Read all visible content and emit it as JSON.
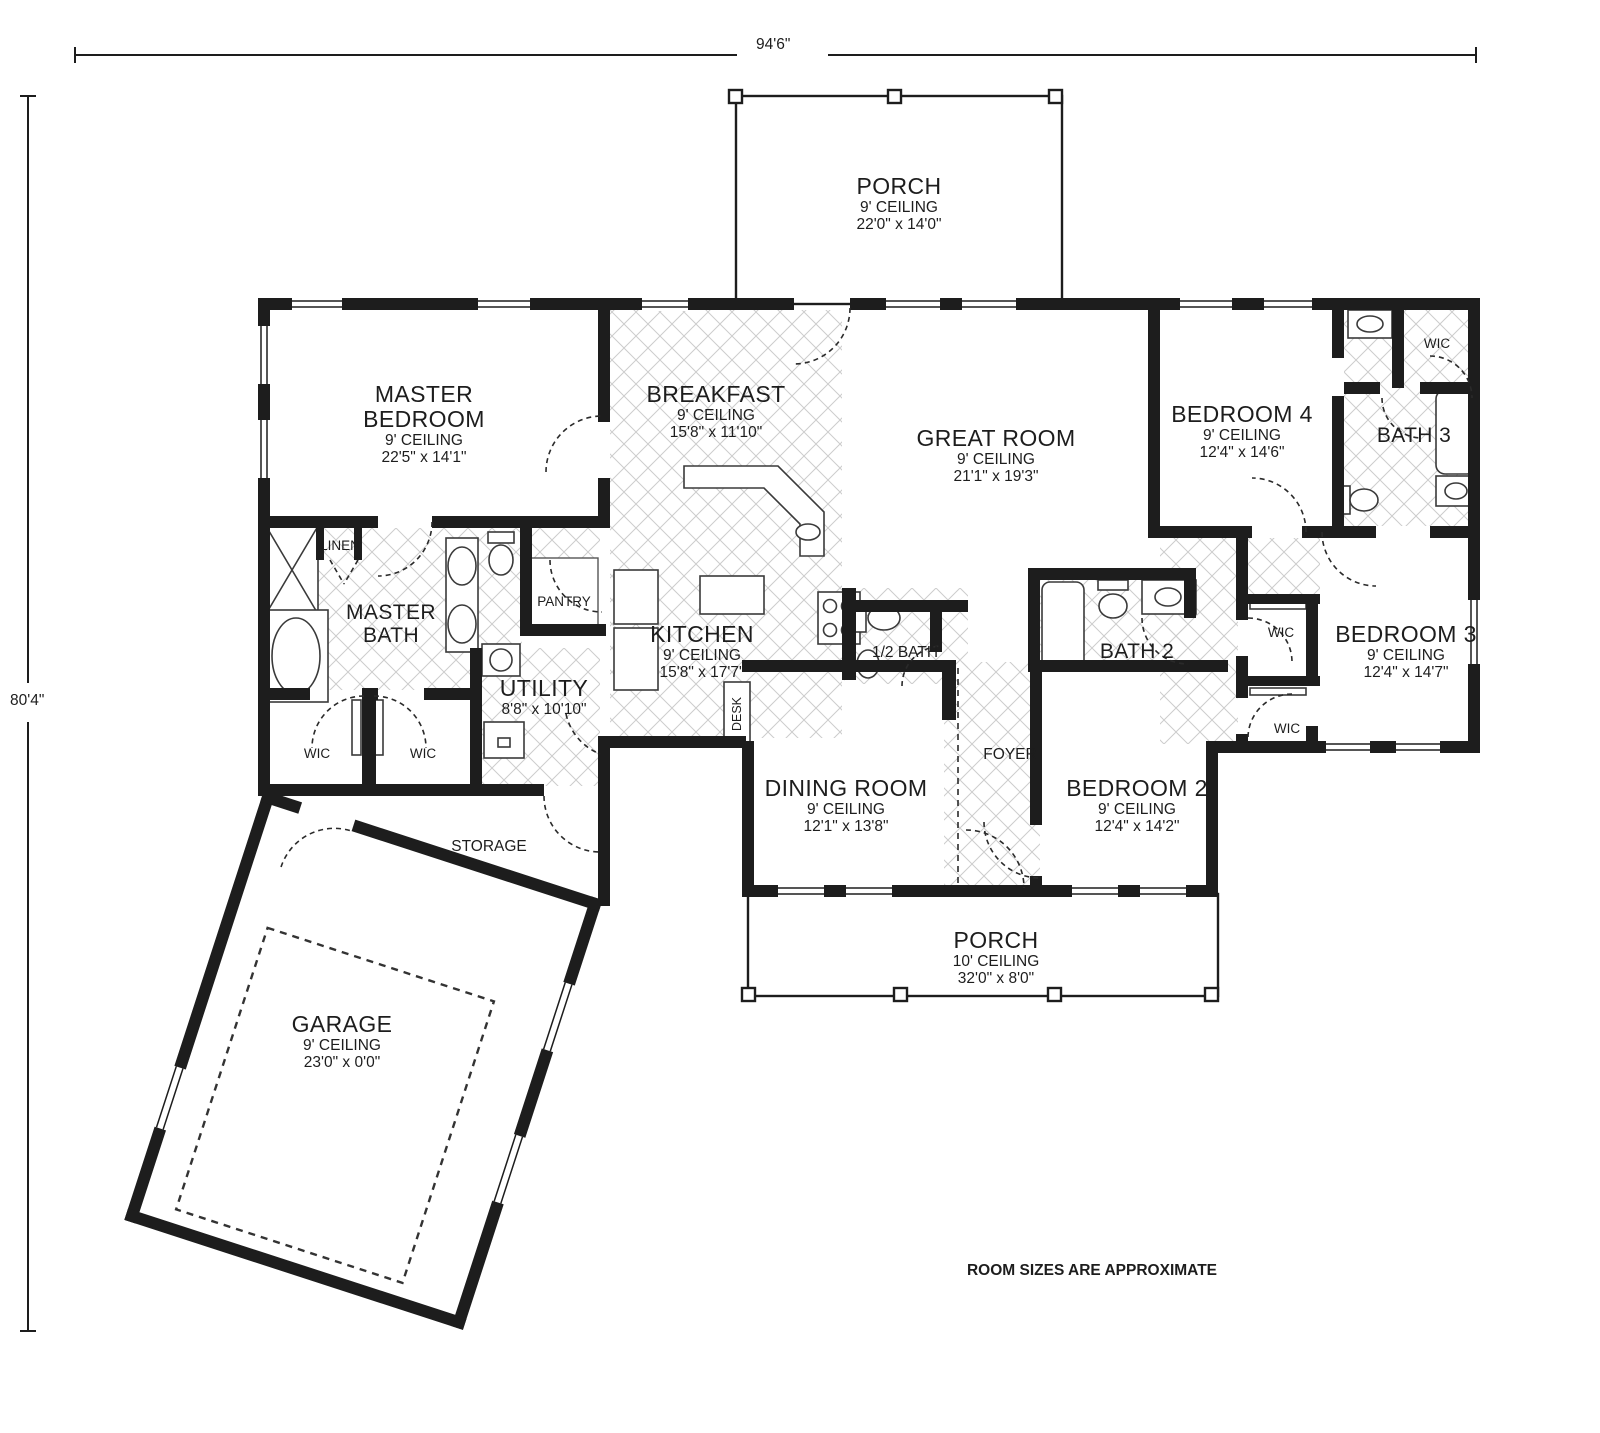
{
  "note": "ROOM SIZES ARE APPROXIMATE",
  "dimensions": {
    "overall_width": "94'6\"",
    "overall_height": "80'4\""
  },
  "colors": {
    "wall": "#1d1d1d",
    "hatch": "#cccccc",
    "fixture": "#3a3a3a"
  },
  "rooms": {
    "porch_top": {
      "name": "PORCH",
      "ceiling": "9' CEILING",
      "size": "22'0\" x 14'0\""
    },
    "master_bedroom": {
      "name": "MASTER BEDROOM",
      "ceiling": "9' CEILING",
      "size": "22'5\" x 14'1\""
    },
    "breakfast": {
      "name": "BREAKFAST",
      "ceiling": "9' CEILING",
      "size": "15'8\" x 11'10\""
    },
    "great_room": {
      "name": "GREAT ROOM",
      "ceiling": "9' CEILING",
      "size": "21'1\" x 19'3\""
    },
    "bedroom4": {
      "name": "BEDROOM 4",
      "ceiling": "9' CEILING",
      "size": "12'4\" x 14'6\""
    },
    "kitchen": {
      "name": "KITCHEN",
      "ceiling": "9' CEILING",
      "size": "15'8\" x 17'7\""
    },
    "bedroom3": {
      "name": "BEDROOM 3",
      "ceiling": "9' CEILING",
      "size": "12'4\" x 14'7\""
    },
    "dining": {
      "name": "DINING ROOM",
      "ceiling": "9' CEILING",
      "size": "12'1\" x 13'8\""
    },
    "bedroom2": {
      "name": "BEDROOM 2",
      "ceiling": "9' CEILING",
      "size": "12'4\" x 14'2\""
    },
    "garage": {
      "name": "GARAGE",
      "ceiling": "9' CEILING",
      "size": "23'0\" x 0'0\""
    },
    "porch_bottom": {
      "name": "PORCH",
      "ceiling": "10' CEILING",
      "size": "32'0\" x 8'0\""
    },
    "utility": {
      "name": "UTILITY",
      "size": "8'8\" x 10'10\""
    }
  },
  "labels": {
    "master_bath": "MASTER BATH",
    "bath2": "BATH 2",
    "bath3": "BATH 3",
    "half_bath": "1/2 BATH",
    "foyer": "FOYER",
    "storage": "STORAGE",
    "linen": "LINEN",
    "pantry": "PANTRY",
    "wic": "WIC",
    "desk": "DESK"
  }
}
